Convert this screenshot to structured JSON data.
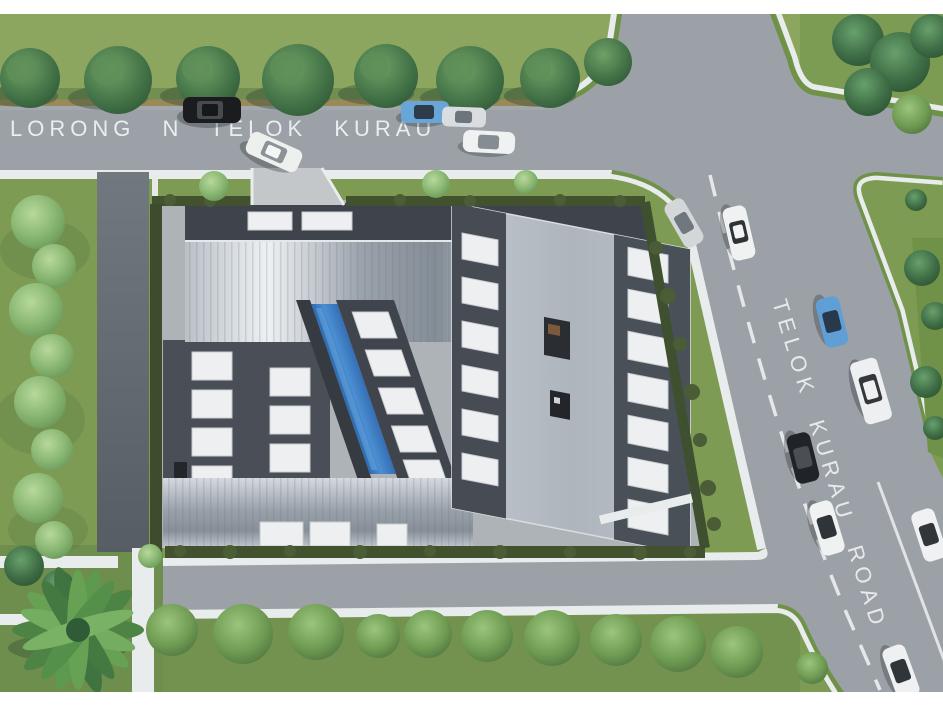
{
  "scene": {
    "description": "aerial architectural site rendering of an industrial building at a road junction",
    "labels": {
      "west_road": "LORONG N TELOK KURAU",
      "main_road": "TELOK KURAU ROAD"
    },
    "palette": {
      "page_bg": "#ffffff",
      "grass": "#7d9b52",
      "grass_top_strip": "#8ca65f",
      "grass_bottom": "#739250",
      "road": "#9ba1a6",
      "sidewalk": "#e9ecec",
      "verge_green": "#6f9148",
      "tan_strip": "#9a8a5a",
      "hedge": "#42522f",
      "tree_dark": "#3c6a40",
      "tree_light": "#8ab873",
      "roof_dark": "#4a4f57",
      "roof_metal_light": "#e8ecef",
      "roof_metal_dark": "#8e969e",
      "building_gray": "#b3bac2",
      "pool_blue": "#3f7fc3",
      "skylight": "#edeff1",
      "road_marking": "#f2f5f6",
      "service_lane": "#62686f"
    },
    "cars": [
      {
        "id": "car-black-west-road",
        "color": "black",
        "hex": "#1a1c1f",
        "glass": "#474b50"
      },
      {
        "id": "car-white-turning-entrance",
        "color": "white",
        "hex": "#eef0ee",
        "glass": "#8b9298"
      },
      {
        "id": "car-blue-west-road",
        "color": "blue",
        "hex": "#69a6d8",
        "glass": "#2c3c4a"
      },
      {
        "id": "car-silver-west-road",
        "color": "silver",
        "hex": "#d9dde0",
        "glass": "#6d747b"
      },
      {
        "id": "car-white-west-road",
        "color": "white",
        "hex": "#f0f2f1",
        "glass": "#858c92"
      },
      {
        "id": "car-silver-intersection",
        "color": "silver",
        "hex": "#d3d7da",
        "glass": "#70777e"
      },
      {
        "id": "car-white-main-road-1",
        "color": "white",
        "hex": "#f0f2f1",
        "glass": "#2f3337"
      },
      {
        "id": "car-blue-main-road",
        "color": "blue",
        "hex": "#5f9fd6",
        "glass": "#27394a"
      },
      {
        "id": "van-white-main-road",
        "color": "white",
        "hex": "#edeff0",
        "glass": "#33383d"
      },
      {
        "id": "car-black-main-road",
        "color": "black",
        "hex": "#202327",
        "glass": "#4a4f55"
      },
      {
        "id": "car-white-main-road-2",
        "color": "white",
        "hex": "#f0f2f1",
        "glass": "#2f3438"
      },
      {
        "id": "car-white-main-road-3",
        "color": "white",
        "hex": "#eff1f2",
        "glass": "#31363a"
      },
      {
        "id": "car-white-main-road-4",
        "color": "white",
        "hex": "#eef0f1",
        "glass": "#30353a"
      }
    ],
    "site_features": {
      "pool": "lap pool courtyard",
      "roofs": "metallic vault roofs with skylights",
      "garden": "palm tree garden"
    }
  }
}
